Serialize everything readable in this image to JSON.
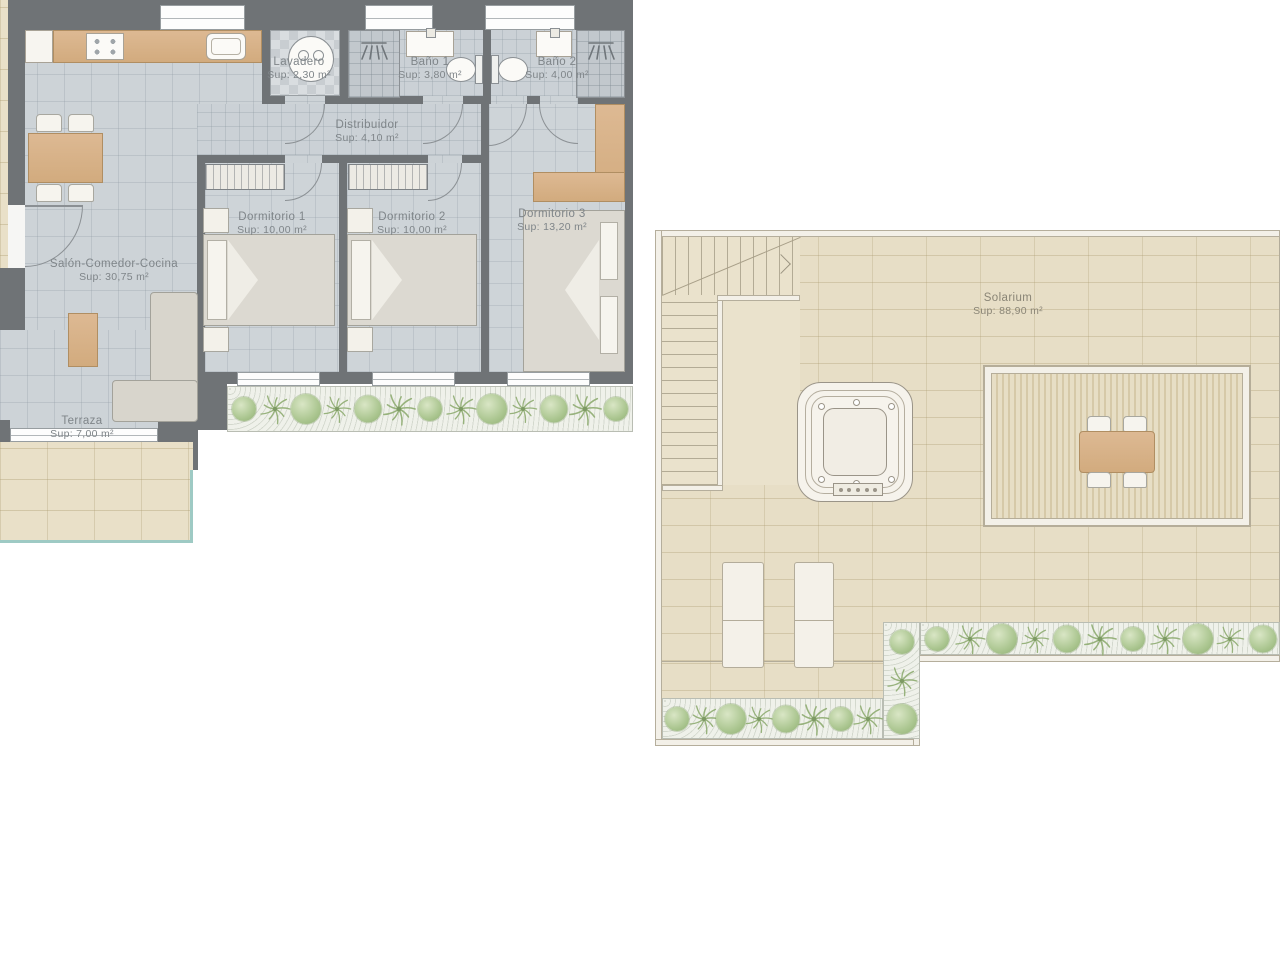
{
  "rooms": {
    "lavadero": {
      "name": "Lavadero",
      "area": "Sup: 2,30 m²"
    },
    "bano1": {
      "name": "Baño 1",
      "area": "Sup: 3,80 m²"
    },
    "bano2": {
      "name": "Baño 2",
      "area": "Sup: 4,00 m²"
    },
    "distribuidor": {
      "name": "Distribuidor",
      "area": "Sup: 4,10 m²"
    },
    "dorm1": {
      "name": "Dormitorio 1",
      "area": "Sup: 10,00 m²"
    },
    "dorm2": {
      "name": "Dormitorio 2",
      "area": "Sup: 10,00 m²"
    },
    "dorm3": {
      "name": "Dormitorio 3",
      "area": "Sup: 13,20 m²"
    },
    "salon": {
      "name": "Salón-Comedor-Cocina",
      "area": "Sup: 30,75 m²"
    },
    "terraza": {
      "name": "Terraza",
      "area": "Sup: 7,00 m²"
    },
    "solarium": {
      "name": "Solarium",
      "area": "Sup: 88,90 m²"
    }
  },
  "colors": {
    "wall": "#6f7376",
    "interior_tile": "#cdd3d7",
    "stone_tile": "#e7dec6",
    "wood": "#d7b189",
    "plant_green": "#9ab97f",
    "glass": "#9ecac4",
    "label_text": "#7f8589"
  }
}
